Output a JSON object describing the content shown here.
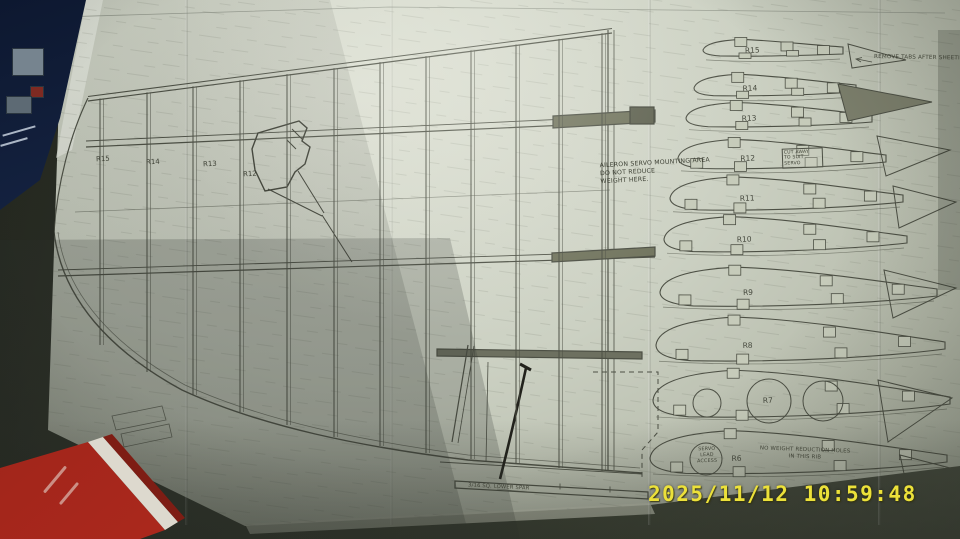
{
  "scene": {
    "timestamp": "2025/11/12 10:59:48",
    "description": "photograph of model aircraft wing plan sheet"
  },
  "annotations": {
    "remove_tabs": "REMOVE TABS AFTER SHEETING TOP S",
    "aileron_servo": "AILERON SERVO MOUNTING AREA\nDO NOT REDUCE\nWEIGHT HERE.",
    "cut_away": "CUT AWAY\nTO SUIT\nSERVO",
    "servo_lead": "SERVO\nLEAD\nACCESS",
    "no_weight": "NO WEIGHT REDUCTION HOLES\nIN THIS RIB",
    "lower_spar": "3/16 SQ. LOWER SPAR"
  },
  "plan_ribs": [
    "R15",
    "R14",
    "R13",
    "R12"
  ],
  "diagram": {
    "wing": {
      "rib_xs": [
        100,
        147,
        193,
        240,
        287,
        334,
        380,
        426,
        471,
        516,
        559,
        602
      ],
      "rib_bottoms": [
        345,
        372,
        395,
        412,
        425,
        437,
        446,
        453,
        459,
        464,
        468,
        471
      ],
      "top_line": {
        "x1": 88,
        "y1": 100,
        "x2": 612,
        "y2": 32
      }
    },
    "rib_templates": [
      {
        "label": "R15",
        "x": 703,
        "y": 50,
        "len": 140,
        "th": 17
      },
      {
        "label": "R14",
        "x": 694,
        "y": 88,
        "len": 162,
        "th": 22
      },
      {
        "label": "R13",
        "x": 686,
        "y": 118,
        "len": 186,
        "th": 25
      },
      {
        "label": "R12",
        "x": 678,
        "y": 158,
        "len": 208,
        "th": 30
      },
      {
        "label": "R11",
        "x": 670,
        "y": 198,
        "len": 233,
        "th": 34
      },
      {
        "label": "R10",
        "x": 664,
        "y": 239,
        "len": 243,
        "th": 36
      },
      {
        "label": "R9",
        "x": 660,
        "y": 292,
        "len": 277,
        "th": 40
      },
      {
        "label": "R8",
        "x": 656,
        "y": 345,
        "len": 289,
        "th": 45
      },
      {
        "label": "R7",
        "x": 653,
        "y": 400,
        "len": 297,
        "th": 48,
        "labelFrac": 0.37,
        "holes": [
          {
            "cx": 707,
            "cy": 403,
            "r": 14
          },
          {
            "cx": 769,
            "cy": 401,
            "r": 22
          },
          {
            "cx": 823,
            "cy": 401,
            "r": 20
          }
        ]
      },
      {
        "label": "R6",
        "x": 650,
        "y": 458,
        "len": 297,
        "th": 44,
        "labelFrac": 0.275,
        "holes": [
          {
            "cx": 706,
            "cy": 459,
            "r": 16
          }
        ]
      }
    ],
    "tip_templates": [
      {
        "pts": "848,44 906,60 852,68",
        "dark": false
      },
      {
        "pts": "838,84 932,102 848,121",
        "dark": true
      },
      {
        "pts": "877,136 950,150 886,176",
        "dark": false
      },
      {
        "pts": "893,186 956,202 899,228",
        "dark": false
      },
      {
        "pts": "884,270 956,288 893,318",
        "dark": false
      },
      {
        "pts": "878,380 952,398 888,442",
        "dark": false
      },
      {
        "pts": "900,455 958,470 908,492",
        "dark": false
      }
    ]
  },
  "colors": {
    "paper": "#c8cdbd",
    "pencil": "#4d5045",
    "timestamp_yellow": "#ece13a",
    "table": "#31352a",
    "book_red": "#a8271c",
    "box_blue": "#16233f"
  }
}
